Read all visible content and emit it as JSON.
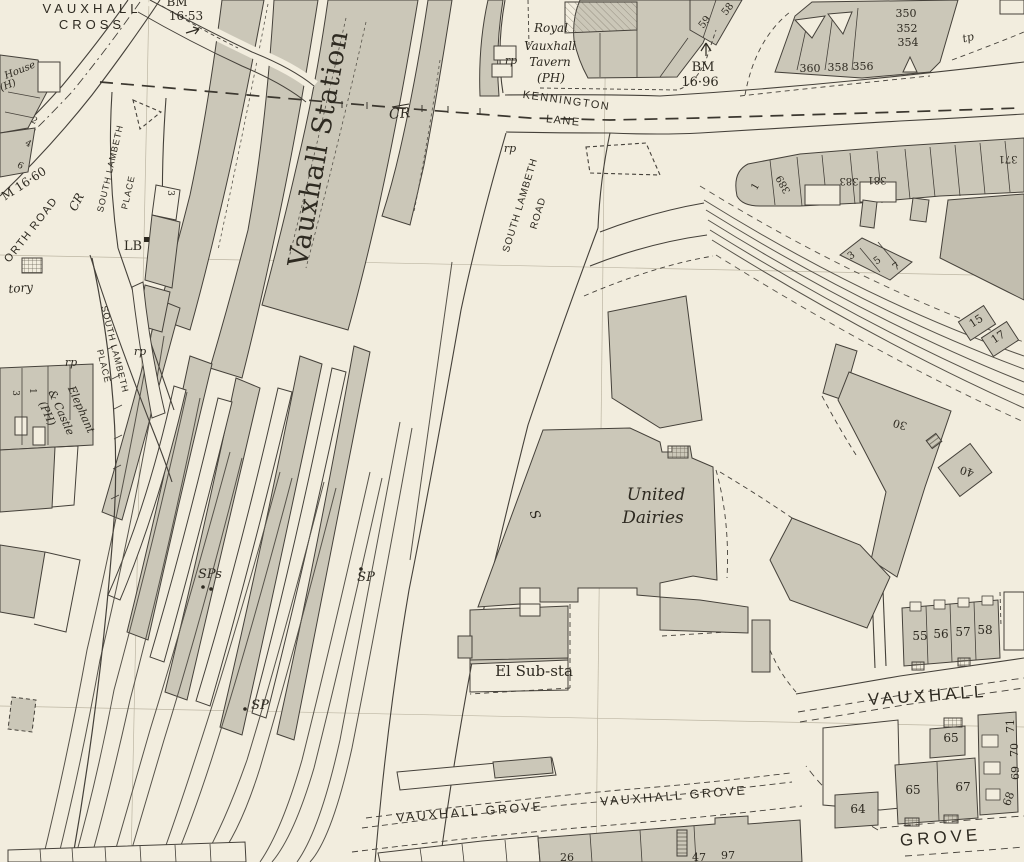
{
  "map": {
    "type": "historic-ordnance-survey-town-plan",
    "area_name": "Vauxhall",
    "colors": {
      "paper": "#f2edde",
      "building": "#cbc7b8",
      "building_dark": "#c2beaf",
      "ink": "#46423a",
      "text": "#2e2a21"
    },
    "labels": [
      {
        "id": "vauxhall-cross-1",
        "text": "VAUXHALL",
        "x": 92,
        "y": 13,
        "rot": 0,
        "cls": "s1"
      },
      {
        "id": "vauxhall-cross-2",
        "text": "CROSS",
        "x": 92,
        "y": 29,
        "rot": 0,
        "cls": "s1"
      },
      {
        "id": "bm-1653-a",
        "text": "BM",
        "x": 177,
        "y": 6,
        "rot": 0,
        "cls": "ser12"
      },
      {
        "id": "bm-1653-b",
        "text": "16·53",
        "x": 186,
        "y": 20,
        "rot": 0,
        "cls": "ser12"
      },
      {
        "id": "house-ph-a",
        "text": "House",
        "x": 21,
        "y": 73,
        "rot": -22,
        "cls": "it10"
      },
      {
        "id": "house-ph-b",
        "text": "(H)",
        "x": 9,
        "y": 88,
        "rot": -22,
        "cls": "it10"
      },
      {
        "id": "house-no-2",
        "text": "2",
        "x": 33,
        "y": 123,
        "rot": 28,
        "cls": "ser9"
      },
      {
        "id": "house-no-4",
        "text": "4",
        "x": 27,
        "y": 146,
        "rot": 28,
        "cls": "ser9"
      },
      {
        "id": "house-no-6",
        "text": "19",
        "x": 0,
        "y": 0,
        "rot": 0,
        "cls": "hidden-none"
      },
      {
        "id": "house-no-6b",
        "text": "6",
        "x": 19,
        "y": 168,
        "rot": 28,
        "cls": "ser9"
      },
      {
        "id": "bm-1660",
        "text": "M 16·60",
        "x": 26,
        "y": 187,
        "rot": -33,
        "cls": "ser12"
      },
      {
        "id": "cr-west",
        "text": "CR",
        "x": 80,
        "y": 204,
        "rot": -62,
        "cls": "it12"
      },
      {
        "id": "wandsworth-road",
        "text": "WANDSWORTH  ROAD",
        "path": "wpath",
        "off": "8",
        "cls": "st11"
      },
      {
        "id": "slp-upper-a",
        "text": "SOUTH LAMBETH",
        "x": 113,
        "y": 169,
        "rot": -77,
        "cls": "st9"
      },
      {
        "id": "slp-upper-b",
        "text": "PLACE",
        "x": 131,
        "y": 193,
        "rot": -77,
        "cls": "st9"
      },
      {
        "id": "slp-lower-a",
        "text": "SOUTH LAMBETH",
        "x": 112,
        "y": 350,
        "rot": 76,
        "cls": "st9"
      },
      {
        "id": "slp-lower-b",
        "text": "PLACE",
        "x": 101,
        "y": 367,
        "rot": 76,
        "cls": "st9"
      },
      {
        "id": "lb",
        "text": "LB",
        "x": 133,
        "y": 250,
        "rot": 0,
        "cls": "ser13"
      },
      {
        "id": "factory",
        "text": "tory",
        "x": 21,
        "y": 292,
        "rot": -5,
        "cls": "it12"
      },
      {
        "id": "vauxhall-station",
        "text": "Vauxhall Station",
        "x": 327,
        "y": 150,
        "rot": -80,
        "cls": "stn"
      },
      {
        "id": "cr-station",
        "text": "CR",
        "x": 400,
        "y": 118,
        "rot": -5,
        "cls": "it14"
      },
      {
        "id": "rp-1",
        "text": "rp",
        "x": 511,
        "y": 64,
        "rot": 0,
        "cls": "it11"
      },
      {
        "id": "tavern-a",
        "text": "Royal",
        "x": 551,
        "y": 32,
        "rot": 0,
        "cls": "it12"
      },
      {
        "id": "tavern-b",
        "text": "Vauxhall",
        "x": 550,
        "y": 50,
        "rot": 0,
        "cls": "it12"
      },
      {
        "id": "tavern-c",
        "text": "Tavern",
        "x": 550,
        "y": 66,
        "rot": 0,
        "cls": "it12"
      },
      {
        "id": "tavern-d",
        "text": "(PH)",
        "x": 551,
        "y": 82,
        "rot": 0,
        "cls": "it12"
      },
      {
        "id": "kennington",
        "text": "KENNINGTON",
        "x": 566,
        "y": 104,
        "rot": 8,
        "cls": "st11"
      },
      {
        "id": "lane",
        "text": "LANE",
        "x": 563,
        "y": 124,
        "rot": 6,
        "cls": "st11"
      },
      {
        "id": "no-59",
        "text": "59",
        "x": 707,
        "y": 24,
        "rot": -52,
        "cls": "ser10"
      },
      {
        "id": "no-58",
        "text": "58",
        "x": 730,
        "y": 11,
        "rot": -52,
        "cls": "ser10"
      },
      {
        "id": "bm-1696-a",
        "text": "BM",
        "x": 703,
        "y": 71,
        "rot": 0,
        "cls": "ser13"
      },
      {
        "id": "bm-1696-b",
        "text": "16·96",
        "x": 700,
        "y": 86,
        "rot": 0,
        "cls": "ser13"
      },
      {
        "id": "no-350",
        "text": "350",
        "x": 906,
        "y": 17,
        "rot": 0,
        "cls": "ser11"
      },
      {
        "id": "no-352",
        "text": "352",
        "x": 907,
        "y": 32,
        "rot": 0,
        "cls": "ser11"
      },
      {
        "id": "no-354",
        "text": "354",
        "x": 908,
        "y": 46,
        "rot": 0,
        "cls": "ser11"
      },
      {
        "id": "no-360",
        "text": "360",
        "x": 810,
        "y": 72,
        "rot": 0,
        "cls": "ser11"
      },
      {
        "id": "no-358",
        "text": "358",
        "x": 838,
        "y": 71,
        "rot": 0,
        "cls": "ser11"
      },
      {
        "id": "no-356",
        "text": "356",
        "x": 863,
        "y": 70,
        "rot": 0,
        "cls": "ser11"
      },
      {
        "id": "tp-1",
        "text": "tp",
        "x": 969,
        "y": 41,
        "rot": -15,
        "cls": "it11"
      },
      {
        "id": "rp-2",
        "text": "rp",
        "x": 510,
        "y": 152,
        "rot": 0,
        "cls": "it11"
      },
      {
        "id": "slr-a",
        "text": "SOUTH LAMBETH",
        "x": 523,
        "y": 206,
        "rot": -73,
        "cls": "st10"
      },
      {
        "id": "slr-b",
        "text": "ROAD",
        "x": 541,
        "y": 214,
        "rot": -73,
        "cls": "st10"
      },
      {
        "id": "no-389",
        "text": "389",
        "x": 786,
        "y": 183,
        "rot": -118,
        "cls": "ser10"
      },
      {
        "id": "no-383",
        "text": "383",
        "x": 849,
        "y": 178,
        "rot": 180,
        "cls": "ser10"
      },
      {
        "id": "no-381",
        "text": "381",
        "x": 877,
        "y": 177,
        "rot": 180,
        "cls": "ser10"
      },
      {
        "id": "no-371",
        "text": "371",
        "x": 1008,
        "y": 156,
        "rot": 180,
        "cls": "ser10"
      },
      {
        "id": "no-1e",
        "text": "1",
        "x": 758,
        "y": 188,
        "rot": -60,
        "cls": "ser10"
      },
      {
        "id": "no-3e",
        "text": "3",
        "x": 853,
        "y": 258,
        "rot": -35,
        "cls": "ser10"
      },
      {
        "id": "no-5e",
        "text": "5",
        "x": 879,
        "y": 263,
        "rot": -35,
        "cls": "ser10"
      },
      {
        "id": "no-7e",
        "text": "7",
        "x": 898,
        "y": 269,
        "rot": -35,
        "cls": "ser10"
      },
      {
        "id": "no-15",
        "text": "15",
        "x": 978,
        "y": 324,
        "rot": -33,
        "cls": "ser11"
      },
      {
        "id": "no-17",
        "text": "17",
        "x": 1000,
        "y": 340,
        "rot": -33,
        "cls": "ser11"
      },
      {
        "id": "no-30",
        "text": "30",
        "x": 901,
        "y": 421,
        "rot": 197,
        "cls": "ser11"
      },
      {
        "id": "no-40",
        "text": "40",
        "x": 968,
        "y": 468,
        "rot": 197,
        "cls": "ser11"
      },
      {
        "id": "rp-3",
        "text": "rp",
        "x": 71,
        "y": 366,
        "rot": 0,
        "cls": "it11"
      },
      {
        "id": "rp-4",
        "text": "rp",
        "x": 140,
        "y": 355,
        "rot": 0,
        "cls": "it11"
      },
      {
        "id": "elephant-a",
        "text": "Elephant",
        "x": 78,
        "y": 411,
        "rot": 66,
        "cls": "it11"
      },
      {
        "id": "elephant-b",
        "text": "& Castle",
        "x": 58,
        "y": 414,
        "rot": 66,
        "cls": "it11"
      },
      {
        "id": "elephant-c",
        "text": "(PH)",
        "x": 44,
        "y": 415,
        "rot": 66,
        "cls": "it11"
      },
      {
        "id": "no-3w",
        "text": "3",
        "x": 13,
        "y": 393,
        "rot": 90,
        "cls": "ser9"
      },
      {
        "id": "no-1w",
        "text": "1",
        "x": 30,
        "y": 391,
        "rot": 90,
        "cls": "ser9"
      },
      {
        "id": "no-3sta",
        "text": "3",
        "x": 168,
        "y": 193,
        "rot": 90,
        "cls": "ser9"
      },
      {
        "id": "sps",
        "text": "SPs",
        "x": 210,
        "y": 578,
        "rot": 0,
        "cls": "it13"
      },
      {
        "id": "sp-1",
        "text": "SP",
        "x": 366,
        "y": 581,
        "rot": 0,
        "cls": "it13"
      },
      {
        "id": "sp-2",
        "text": "SP",
        "x": 260,
        "y": 709,
        "rot": 0,
        "cls": "it13"
      },
      {
        "id": "united-a",
        "text": "United",
        "x": 656,
        "y": 500,
        "rot": 0,
        "cls": "it17"
      },
      {
        "id": "united-b",
        "text": "Dairies",
        "x": 653,
        "y": 523,
        "rot": 0,
        "cls": "it17"
      },
      {
        "id": "s-mark",
        "text": "S",
        "x": 531,
        "y": 516,
        "rot": 70,
        "cls": "it13"
      },
      {
        "id": "el-sub-sta",
        "text": "El Sub-sta",
        "x": 534,
        "y": 676,
        "rot": 0,
        "cls": "ser15"
      },
      {
        "id": "vx-grove-1",
        "text": "VAUXHALL  GROVE",
        "x": 470,
        "y": 816,
        "rot": -4.5,
        "cls": "st12"
      },
      {
        "id": "vx-grove-2",
        "text": "VAUXHALL  GROVE",
        "x": 674,
        "y": 800,
        "rot": -4.5,
        "cls": "st12"
      },
      {
        "id": "vauxhall-street",
        "text": "VAUXHALL",
        "x": 928,
        "y": 701,
        "rot": -4,
        "cls": "st16"
      },
      {
        "id": "grove-street",
        "text": "GROVE",
        "x": 941,
        "y": 843,
        "rot": -4,
        "cls": "st16"
      },
      {
        "id": "no-55",
        "text": "55",
        "x": 920,
        "y": 640,
        "rot": 0,
        "cls": "ser12"
      },
      {
        "id": "no-56",
        "text": "56",
        "x": 941,
        "y": 638,
        "rot": 0,
        "cls": "ser12"
      },
      {
        "id": "no-57",
        "text": "57",
        "x": 963,
        "y": 636,
        "rot": 0,
        "cls": "ser12"
      },
      {
        "id": "no-58b",
        "text": "58",
        "x": 985,
        "y": 634,
        "rot": 0,
        "cls": "ser12"
      },
      {
        "id": "no-65a",
        "text": "65",
        "x": 951,
        "y": 742,
        "rot": 0,
        "cls": "ser12"
      },
      {
        "id": "no-65b",
        "text": "65",
        "x": 913,
        "y": 794,
        "rot": 0,
        "cls": "ser12"
      },
      {
        "id": "no-67",
        "text": "67",
        "x": 963,
        "y": 791,
        "rot": 0,
        "cls": "ser12"
      },
      {
        "id": "no-64",
        "text": "64",
        "x": 858,
        "y": 813,
        "rot": 0,
        "cls": "ser12"
      },
      {
        "id": "no-68",
        "text": "68",
        "x": 1012,
        "y": 800,
        "rot": -70,
        "cls": "ser11"
      },
      {
        "id": "no-69",
        "text": "69",
        "x": 1019,
        "y": 773,
        "rot": -90,
        "cls": "ser11"
      },
      {
        "id": "no-70",
        "text": "70",
        "x": 1018,
        "y": 750,
        "rot": -90,
        "cls": "ser11"
      },
      {
        "id": "no-71",
        "text": "71",
        "x": 1014,
        "y": 726,
        "rot": -90,
        "cls": "ser11"
      },
      {
        "id": "no-26",
        "text": "26",
        "x": 567,
        "y": 861,
        "rot": 0,
        "cls": "ser11"
      },
      {
        "id": "no-47",
        "text": "47",
        "x": 699,
        "y": 861,
        "rot": 0,
        "cls": "ser11"
      },
      {
        "id": "no-97",
        "text": "97",
        "x": 728,
        "y": 859,
        "rot": 0,
        "cls": "ser11"
      }
    ]
  }
}
